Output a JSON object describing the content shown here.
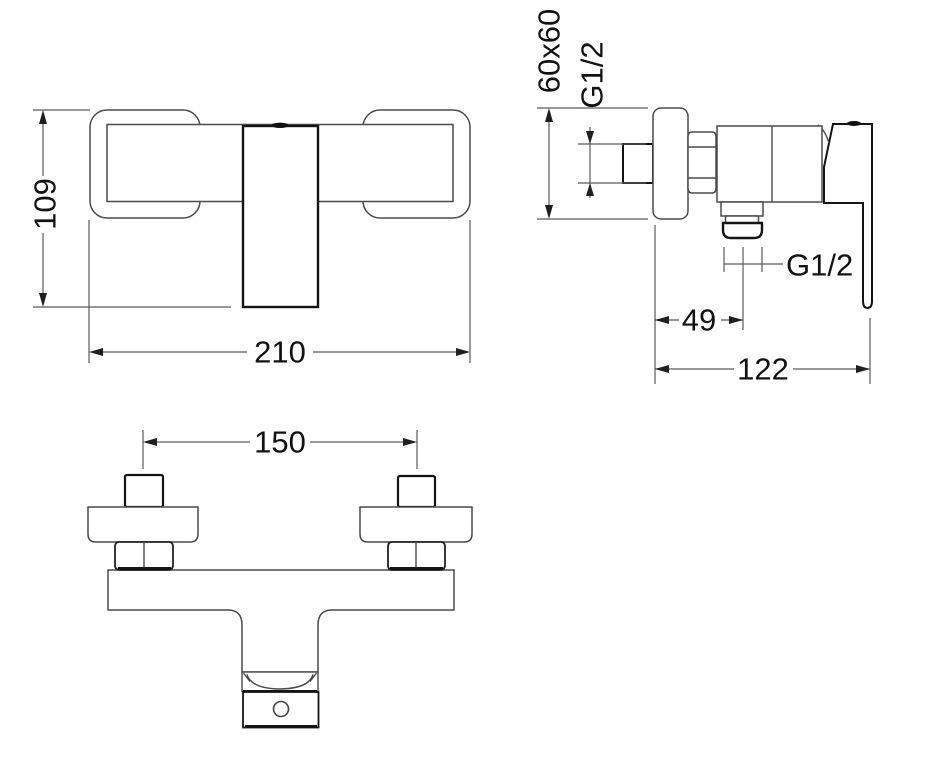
{
  "drawing": {
    "background": "#ffffff",
    "line_color": "#4a4a4a",
    "emphasis_color": "#141414",
    "dimension_color": "#5b5b5b",
    "text_color": "#111111"
  },
  "front_view": {
    "height_mm": "109",
    "width_mm": "210"
  },
  "side_view": {
    "plate_size": "60x60",
    "inlet_thread": "G1/2",
    "outlet_thread": "G1/2",
    "outlet_offset_mm": "49",
    "depth_mm": "122"
  },
  "bottom_view": {
    "hole_spacing_mm": "150"
  }
}
